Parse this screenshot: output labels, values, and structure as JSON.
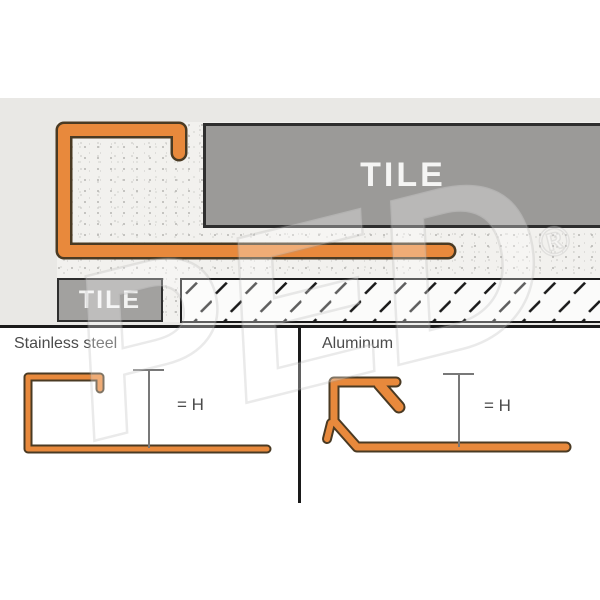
{
  "diagram": {
    "installation": {
      "tile_top_label": "TILE",
      "tile_side_label": "TILE"
    },
    "panels": [
      {
        "label": "Stainless steel",
        "height_label": "= H"
      },
      {
        "label": "Aluminum",
        "height_label": "= H"
      }
    ],
    "watermark": {
      "text": "PED",
      "registered_mark": "®"
    },
    "colors": {
      "profile_orange": "#E8893C",
      "profile_outline": "#4A3A23",
      "tile_gray": "#9B9A98",
      "background_band": "#E9E8E5",
      "line_black": "#1A1A1A",
      "label_gray": "#4B4B4B"
    }
  }
}
